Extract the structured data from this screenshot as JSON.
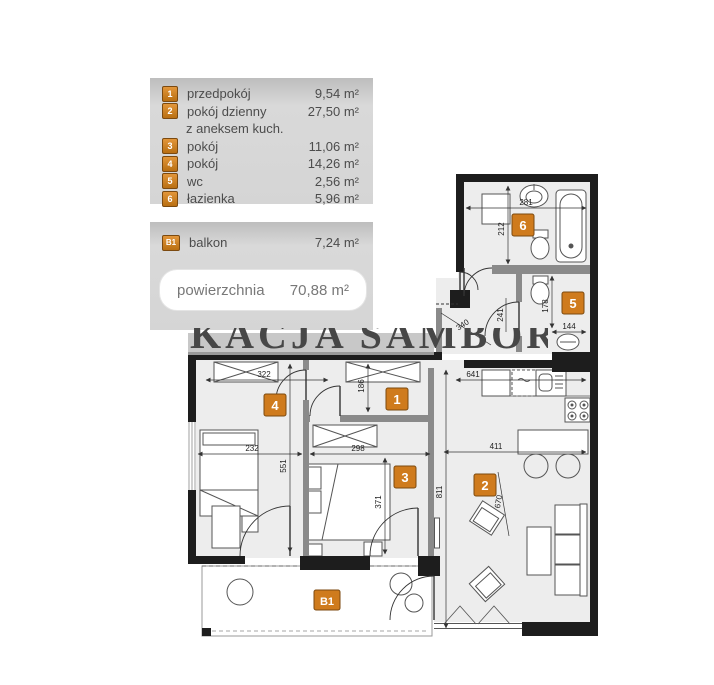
{
  "legend": {
    "rooms": [
      {
        "id": "1",
        "name": "przedpokój",
        "area": "9,54 m²"
      },
      {
        "id": "2",
        "name": "pokój dzienny",
        "note": "z aneksem kuch.",
        "area": "27,50 m²"
      },
      {
        "id": "3",
        "name": "pokój",
        "area": "11,06 m²"
      },
      {
        "id": "4",
        "name": "pokój",
        "area": "14,26 m²"
      },
      {
        "id": "5",
        "name": "wc",
        "area": "2,56 m²"
      },
      {
        "id": "6",
        "name": "łazienka",
        "area": "5,96 m²"
      }
    ],
    "balcony_row": {
      "id": "B1",
      "name": "balkon",
      "area": "7,24 m²"
    },
    "total_label": "powierzchnia",
    "total_value": "70,88 m²"
  },
  "watermark": "KACJA SAMBORSCY",
  "plan": {
    "markers": {
      "m1": "1",
      "m2": "2",
      "m3": "3",
      "m4": "4",
      "m5": "5",
      "m6": "6",
      "b1": "B1"
    },
    "dimensions": {
      "bath_width": "281",
      "bath_depth": "212",
      "wc_depth": "178",
      "wc_width": "144",
      "kitchen_wall": "641",
      "living_width": "411",
      "living_depth": "811",
      "living_diag": "670",
      "room4_top": "322",
      "hall_depth": "186",
      "room4_width": "232",
      "room3_width": "298",
      "room4_depth": "551",
      "room3_depth": "371",
      "hall_diag": "340",
      "door": "241"
    }
  },
  "colors": {
    "accent_orange": "#cf7b1d",
    "wall_black": "#1d1d1d",
    "room_fill": "#ededed",
    "legend_gray": "#d5d5d5"
  }
}
